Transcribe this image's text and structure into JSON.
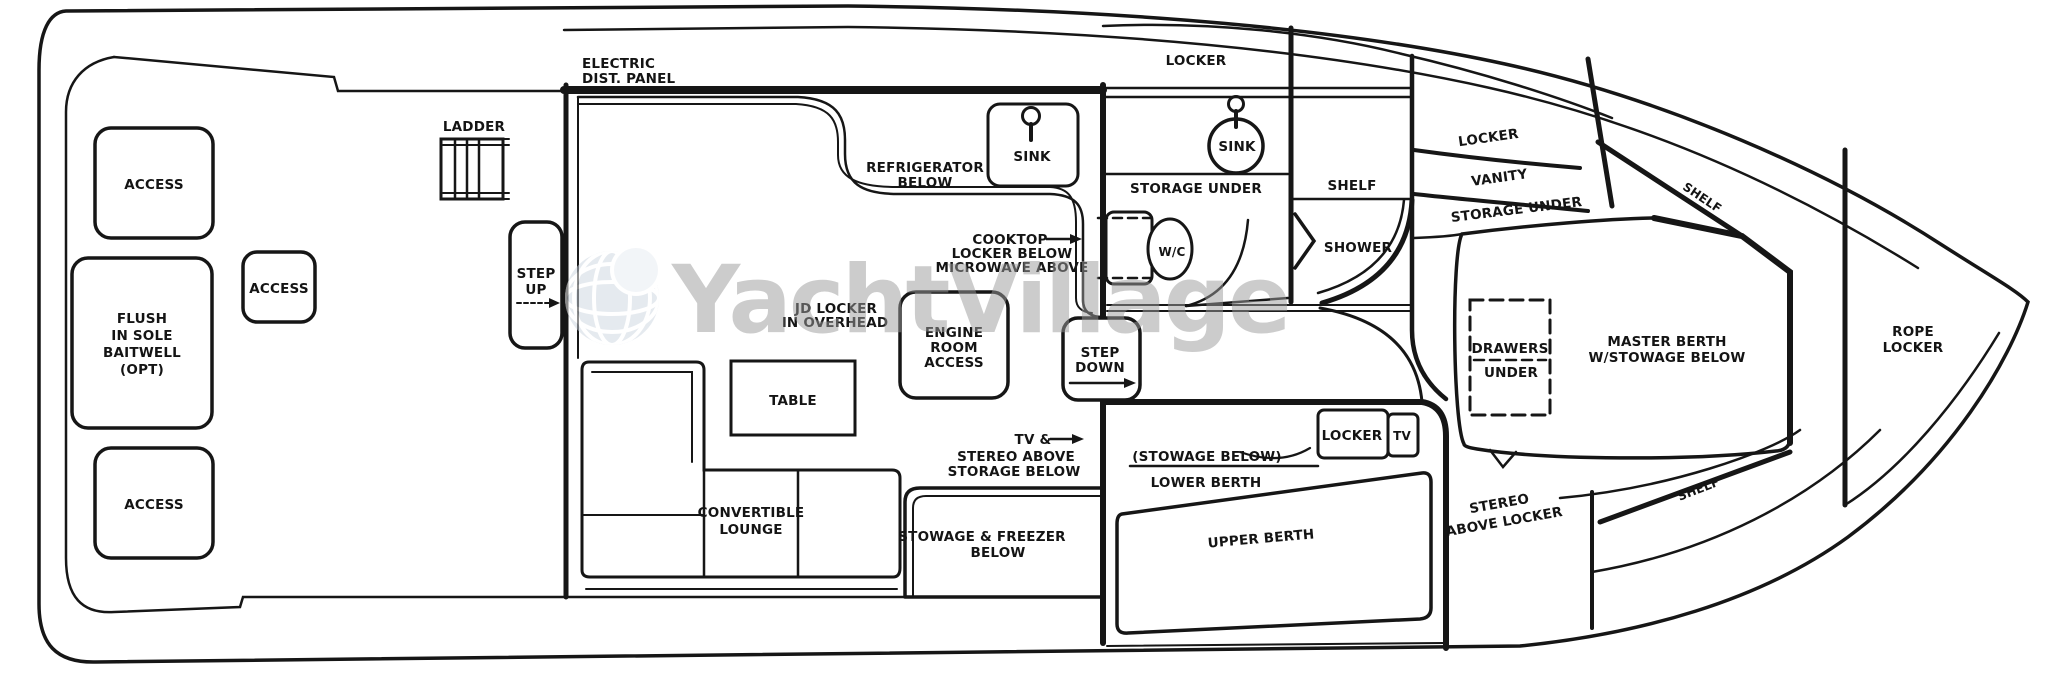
{
  "meta": {
    "title": "Yacht interior deck floor plan",
    "ink_color": "#161616",
    "paper_color": "#ffffff"
  },
  "watermark": {
    "text": "YachtVillage",
    "text_color": "#9b9b9b",
    "globe_fill": "#cdd6e0",
    "globe_grid": "#ffffff",
    "globe_highlight": "#e7ecf2"
  },
  "labels": {
    "access_aft_top": "ACCESS",
    "access_mid": "ACCESS",
    "access_aft_bottom": "ACCESS",
    "flush_baitwell": {
      "lines": [
        "FLUSH",
        "IN SOLE",
        "BAITWELL",
        "(OPT)"
      ]
    },
    "ladder": "LADDER",
    "step_up": {
      "lines": [
        "STEP",
        "UP"
      ]
    },
    "electric_panel": {
      "lines": [
        "ELECTRIC",
        "DIST. PANEL"
      ]
    },
    "refrigerator": {
      "lines": [
        "REFRIGERATOR",
        "BELOW"
      ]
    },
    "sink_galley": "SINK",
    "cooktop": {
      "lines": [
        "COOKTOP",
        "LOCKER BELOW",
        "MICROWAVE ABOVE"
      ]
    },
    "overhead_locker": {
      "lines": [
        "JD LOCKER",
        "IN OVERHEAD"
      ]
    },
    "engine_room": {
      "lines": [
        "ENGINE",
        "ROOM",
        "ACCESS"
      ]
    },
    "step_down": {
      "lines": [
        "STEP",
        "DOWN"
      ]
    },
    "table": "TABLE",
    "convertible_lounge": {
      "lines": [
        "CONVERTIBLE",
        "LOUNGE"
      ]
    },
    "tv_stereo": {
      "lines": [
        "TV &",
        "STEREO ABOVE",
        "STORAGE BELOW"
      ]
    },
    "stowage_freezer": {
      "lines": [
        "STOWAGE & FREEZER",
        "BELOW"
      ]
    },
    "locker_head": "LOCKER",
    "sink_head": "SINK",
    "storage_under_head": "STORAGE UNDER",
    "wc": "W/C",
    "shelf_mid": "SHELF",
    "shower": "SHOWER",
    "locker_guest": "LOCKER",
    "tv_guest": "TV",
    "stowage_below_guest": "(STOWAGE BELOW)",
    "lower_berth": "LOWER BERTH",
    "upper_berth": "UPPER BERTH",
    "stereo_above_locker": {
      "lines": [
        "STEREO",
        "ABOVE LOCKER"
      ]
    },
    "locker_fwd": "LOCKER",
    "vanity": "VANITY",
    "storage_under_fwd": "STORAGE UNDER",
    "shelf_upper": "SHELF",
    "shelf_lower": "SHELF",
    "drawers_under": {
      "lines": [
        "DRAWERS",
        "UNDER"
      ]
    },
    "master_berth": {
      "lines": [
        "MASTER BERTH",
        "W/STOWAGE BELOW"
      ]
    },
    "rope_locker": {
      "lines": [
        "ROPE",
        "LOCKER"
      ]
    }
  }
}
